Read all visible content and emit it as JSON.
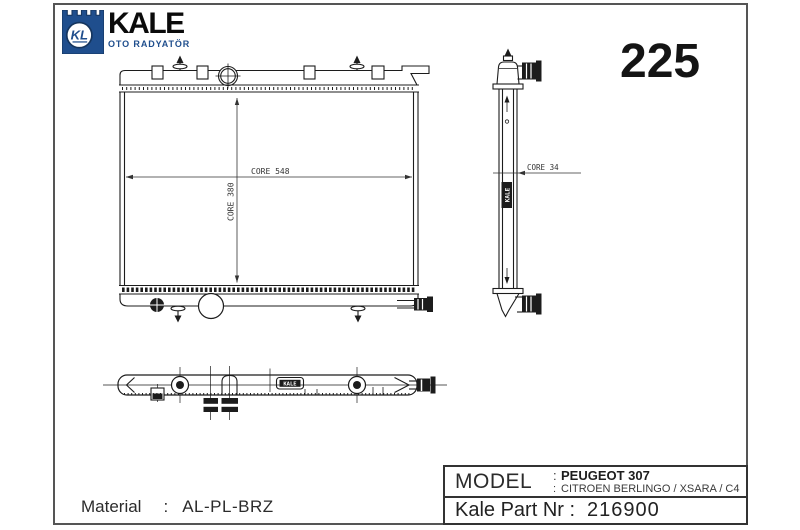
{
  "sheet": {
    "page_number": "225",
    "material": {
      "label": "Material",
      "separator": ":",
      "value": "AL-PL-BRZ"
    }
  },
  "logo": {
    "monogram": "KL",
    "brand": "KALE",
    "subtitle": "OTO RADYATÖR",
    "brand_blue": "#1f4e8d"
  },
  "drawing": {
    "front_view": {
      "core_width_label": "CORE 548",
      "core_height_label": "CORE 380"
    },
    "side_view": {
      "core_depth_label": "CORE 34",
      "brand_tag": "KALE"
    },
    "bottom_view": {
      "brand_tag": "KALE"
    }
  },
  "title_block": {
    "model_label": "MODEL",
    "model_separator": ":",
    "models": [
      "PEUGEOT 307",
      "CITROEN BERLINGO / XSARA / C4"
    ],
    "part_label": "Kale Part Nr :",
    "part_number": "216900"
  }
}
